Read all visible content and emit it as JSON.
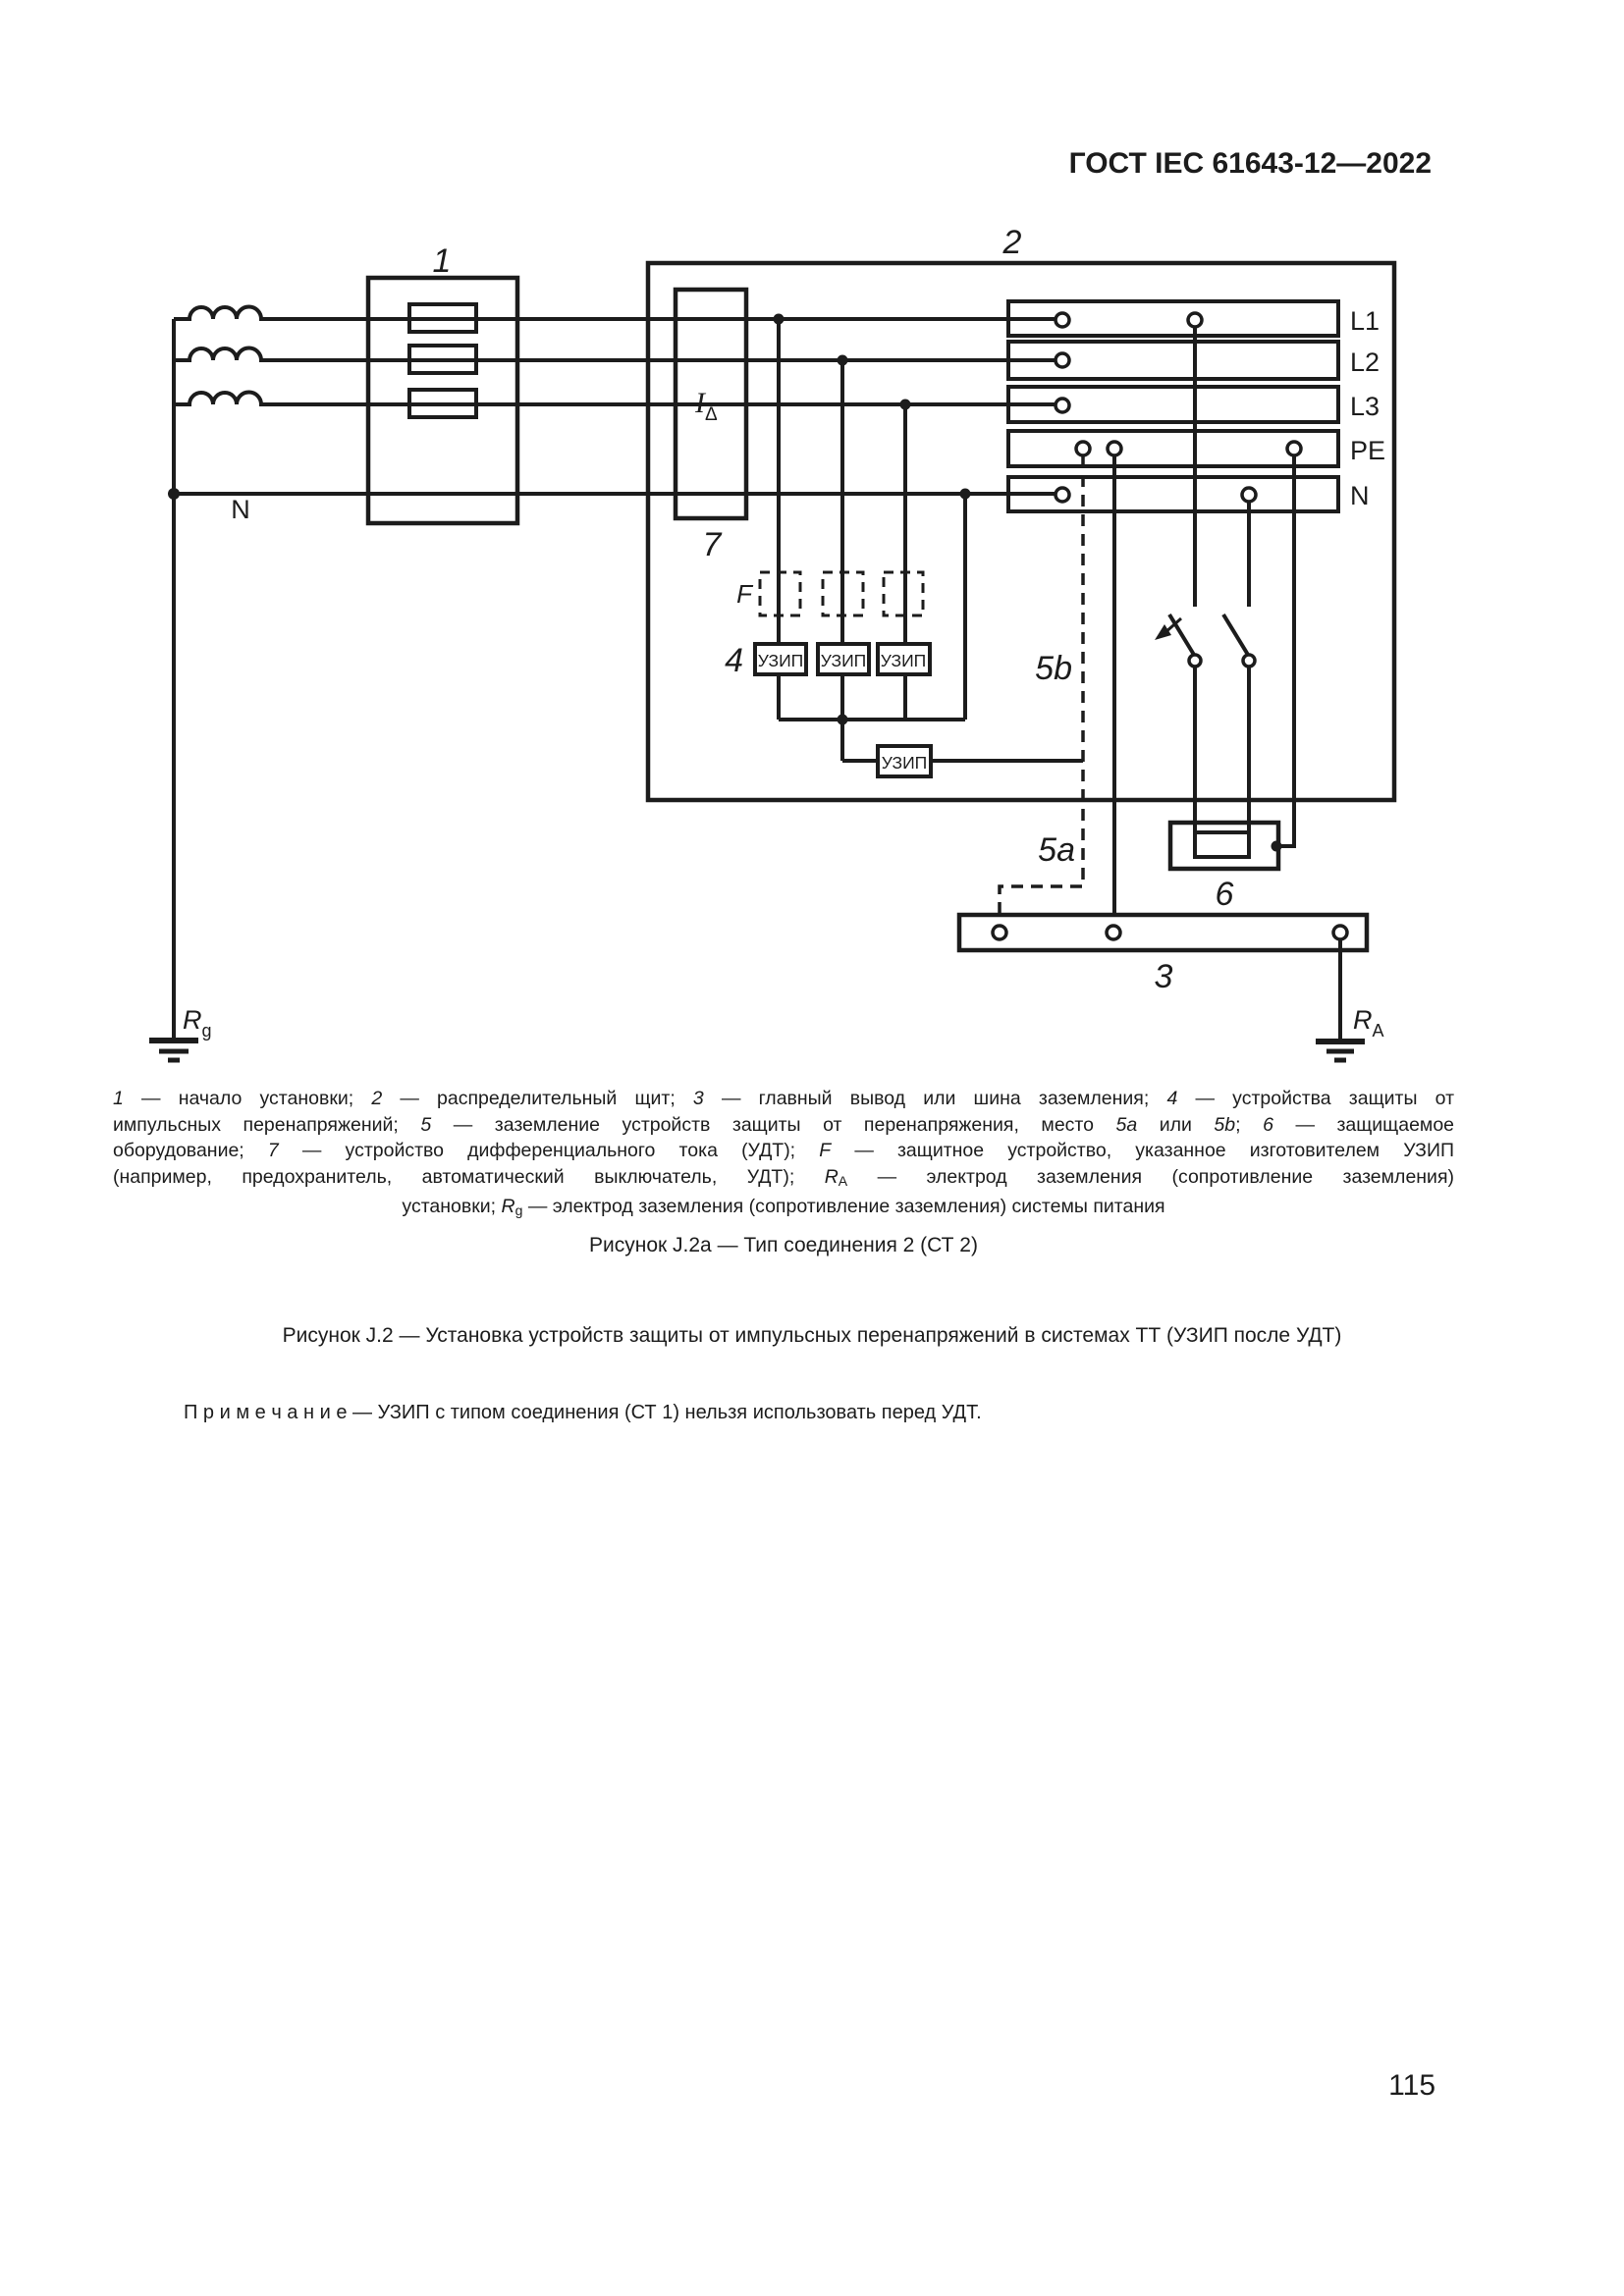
{
  "header": {
    "title": "ГОСТ IEC 61643-12—2022"
  },
  "diagram": {
    "ref": {
      "n1": "1",
      "n2": "2",
      "n3": "3",
      "n4": "4",
      "n5a": "5a",
      "n5b": "5b",
      "n6": "6",
      "n7": "7"
    },
    "f_label": "F",
    "rcd": {
      "main": "I",
      "sub": "Δ"
    },
    "spd_label": "УЗИП",
    "source_neutral": "N",
    "bus": [
      "L1",
      "L2",
      "L3",
      "PE",
      "N"
    ],
    "earth_source": {
      "main": "R",
      "sub": "g"
    },
    "earth_installation": {
      "main": "R",
      "sub": "A"
    },
    "line_color": "#1c1c1c"
  },
  "legend": {
    "lines": [
      [
        {
          "t": "1",
          "i": true
        },
        {
          "t": " — начало установки; "
        },
        {
          "t": "2",
          "i": true
        },
        {
          "t": " — распределительный щит; "
        },
        {
          "t": "3",
          "i": true
        },
        {
          "t": " — главный вывод или шина заземления; "
        },
        {
          "t": "4",
          "i": true
        },
        {
          "t": " — устройства защиты от"
        }
      ],
      [
        {
          "t": "импульсных перенапряжений; "
        },
        {
          "t": "5",
          "i": true
        },
        {
          "t": " — заземление устройств защиты от перенапряжения, место "
        },
        {
          "t": "5a",
          "i": true
        },
        {
          "t": " или "
        },
        {
          "t": "5b",
          "i": true
        },
        {
          "t": "; "
        },
        {
          "t": "6",
          "i": true
        },
        {
          "t": " — защищаемое"
        }
      ],
      [
        {
          "t": "оборудование; "
        },
        {
          "t": "7",
          "i": true
        },
        {
          "t": " — устройство дифференциального тока (УДТ); "
        },
        {
          "t": "F",
          "i": true
        },
        {
          "t": " — защитное устройство, указанное изготовителем УЗИП"
        }
      ],
      [
        {
          "t": "(например, предохранитель, автоматический выключатель, УДТ); "
        },
        {
          "t": "R",
          "i": true
        },
        {
          "t": "A",
          "sub": true
        },
        {
          "t": " — электрод заземления (сопротивление заземления)"
        }
      ],
      [
        {
          "t": "установки; "
        },
        {
          "t": "R",
          "i": true
        },
        {
          "t": "g",
          "sub": true
        },
        {
          "t": " — электрод заземления (сопротивление заземления) системы питания"
        }
      ]
    ]
  },
  "captions": {
    "fig_a": "Рисунок J.2a — Тип соединения 2 (СТ 2)",
    "fig_main": "Рисунок J.2 — Установка устройств защиты от импульсных перенапряжений в системах ТТ (УЗИП после УДТ)",
    "note": "П р и м е ч а н и е  — УЗИП с типом соединения (СТ 1) нельзя использовать перед УДТ."
  },
  "page": {
    "number": "115"
  }
}
